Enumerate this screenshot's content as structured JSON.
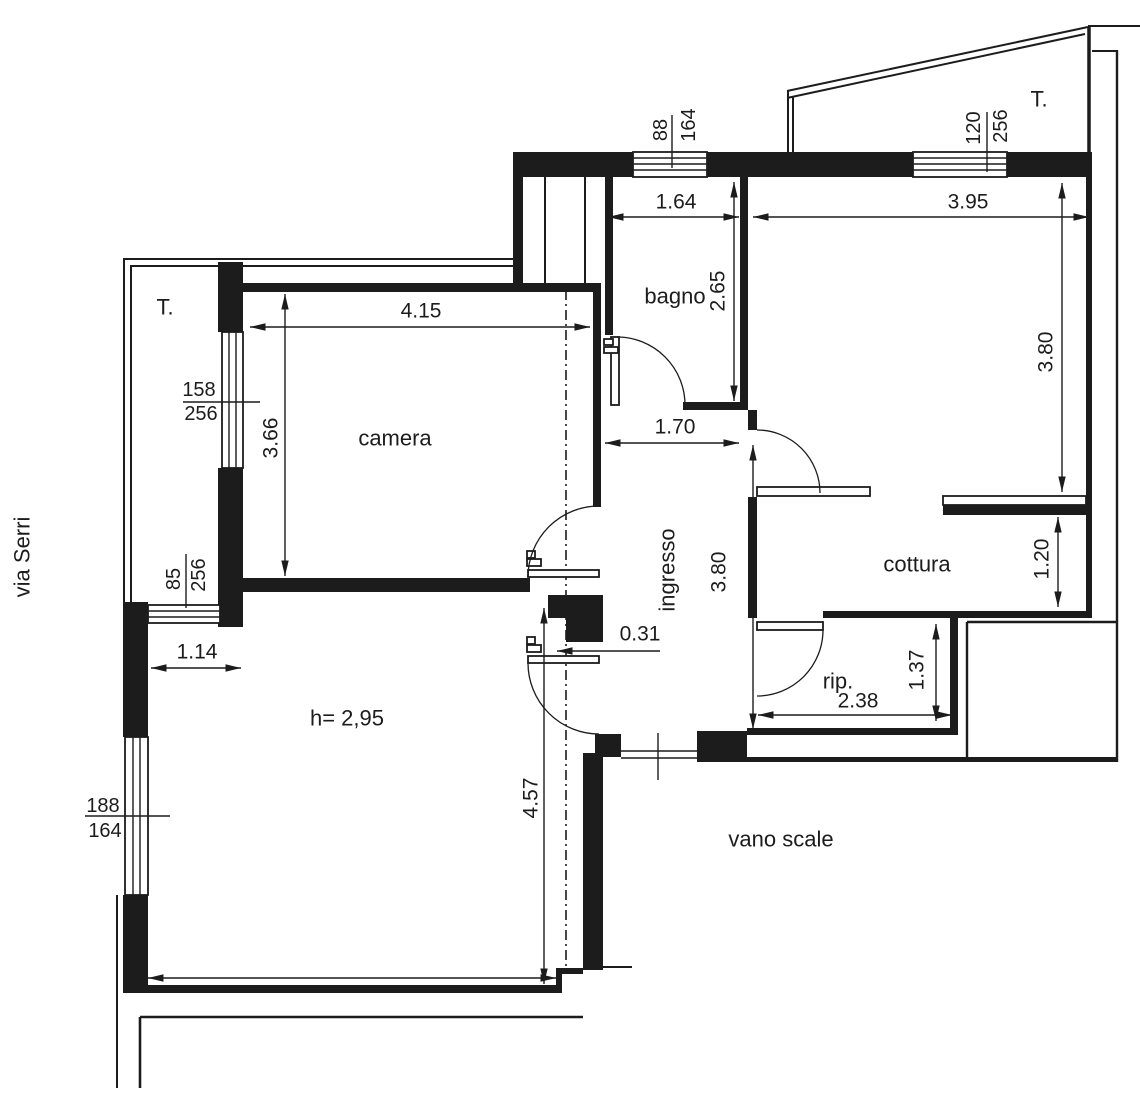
{
  "street": {
    "label": "via Serri"
  },
  "terraces": {
    "left": "T.",
    "right": "T."
  },
  "rooms": {
    "camera": "camera",
    "bagno": "bagno",
    "ingresso": "ingresso",
    "cottura": "cottura",
    "rip": "rip.",
    "vano_scale": "vano scale",
    "living_height": "h= 2,95"
  },
  "dimensions": {
    "camera_width": "4.15",
    "camera_depth": "3.66",
    "bagno_width": "1.64",
    "bagno_depth": "2.65",
    "cottura_width": "3.95",
    "cottura_depth": "3.80",
    "cottura_counter": "1.20",
    "ingresso_width": "1.70",
    "ingresso_depth": "3.80",
    "wall_offset": "0.31",
    "rip_width": "2.38",
    "rip_depth": "1.37",
    "window_offset": "1.14",
    "living_depth": "4.57"
  },
  "windows": {
    "bagno_top": {
      "width": "88",
      "height": "164"
    },
    "cottura_top": {
      "width": "120",
      "height": "256"
    },
    "camera_left": {
      "width": "158",
      "height": "256"
    },
    "living_top": {
      "width": "85",
      "height": "256"
    },
    "living_left": {
      "width": "188",
      "height": "164"
    }
  },
  "colors": {
    "line": "#1c1c1c",
    "background": "#ffffff"
  }
}
